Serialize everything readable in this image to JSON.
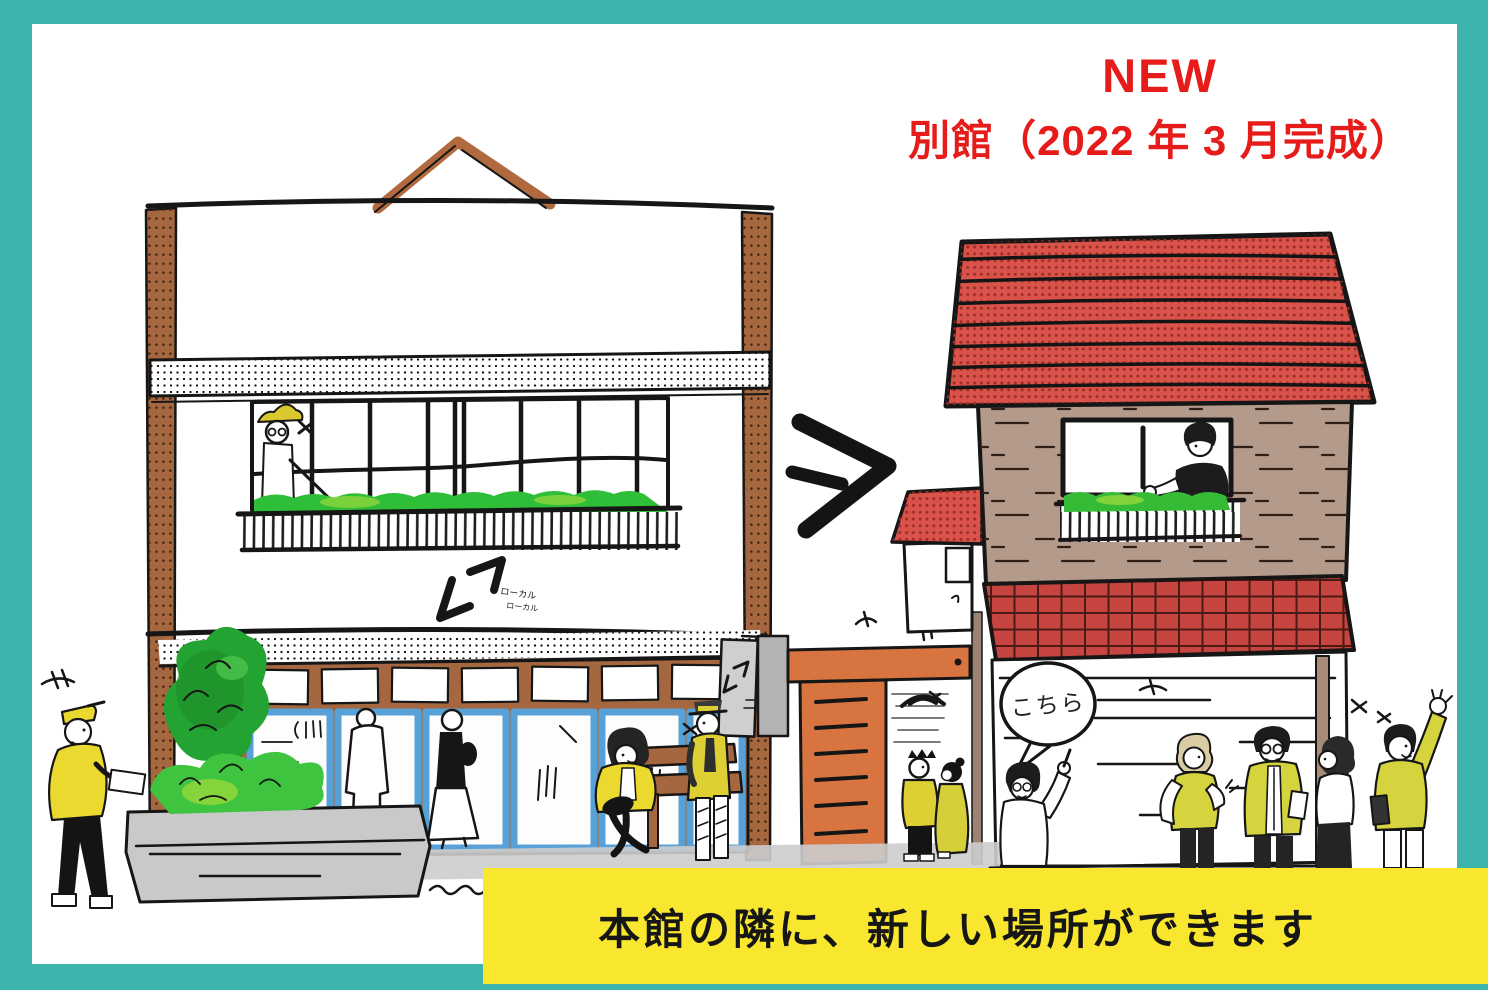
{
  "announcement": {
    "badge": "NEW",
    "title": "別館（2022 年 3 月完成）"
  },
  "banner": {
    "text": "本館の隣に、新しい場所ができます"
  },
  "speech_bubble": {
    "text": "こちら"
  },
  "logo": {
    "text": "ローカル"
  },
  "colors": {
    "frame_teal": "#3db4ab",
    "accent_red": "#e51c1a",
    "banner_yellow": "#f8e62f",
    "roof_red": "#d9534b",
    "awning_red": "#c64540",
    "brick_tan": "#b49a8a",
    "door_orange": "#d7743f",
    "pillar_brown": "#a5673f",
    "window_blue": "#57a1d6",
    "foliage_green": "#2fbe37",
    "people_yellow": "#decf35"
  }
}
